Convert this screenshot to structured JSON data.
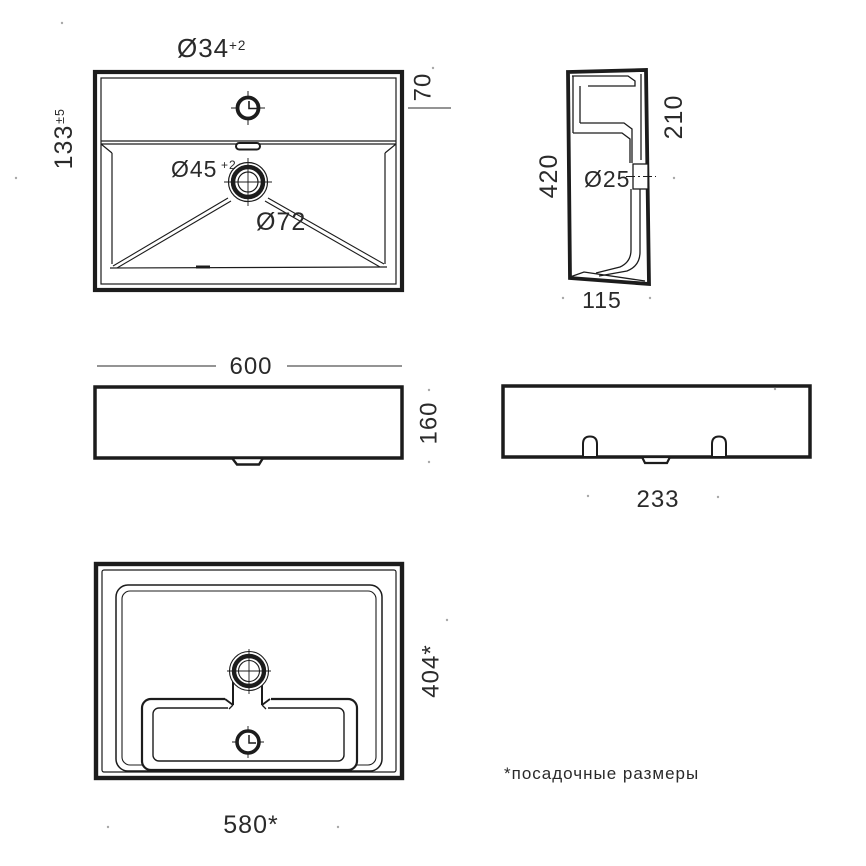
{
  "colors": {
    "line": "#1c1c1c",
    "text": "#2a2a2a",
    "artifact": "#a8a8a8",
    "background": "#ffffff"
  },
  "top_view": {
    "faucet_diameter": "Ø34",
    "faucet_tolerance": "+2",
    "rim_height": "133",
    "rim_tolerance": "±5",
    "deck_depth": "70",
    "drain_diameter": "Ø45",
    "drain_tolerance": "+2",
    "recess_diameter": "Ø72"
  },
  "side_view": {
    "total_height": "420",
    "front_edge_height": "210",
    "overflow_diameter": "Ø25",
    "depth": "115"
  },
  "front_view": {
    "width": "600",
    "height": "160"
  },
  "rear_view": {
    "bracket_spacing": "233"
  },
  "bottom_view": {
    "mounting_depth": "404*",
    "mounting_width": "580*"
  },
  "footnote": "*посадочные размеры"
}
